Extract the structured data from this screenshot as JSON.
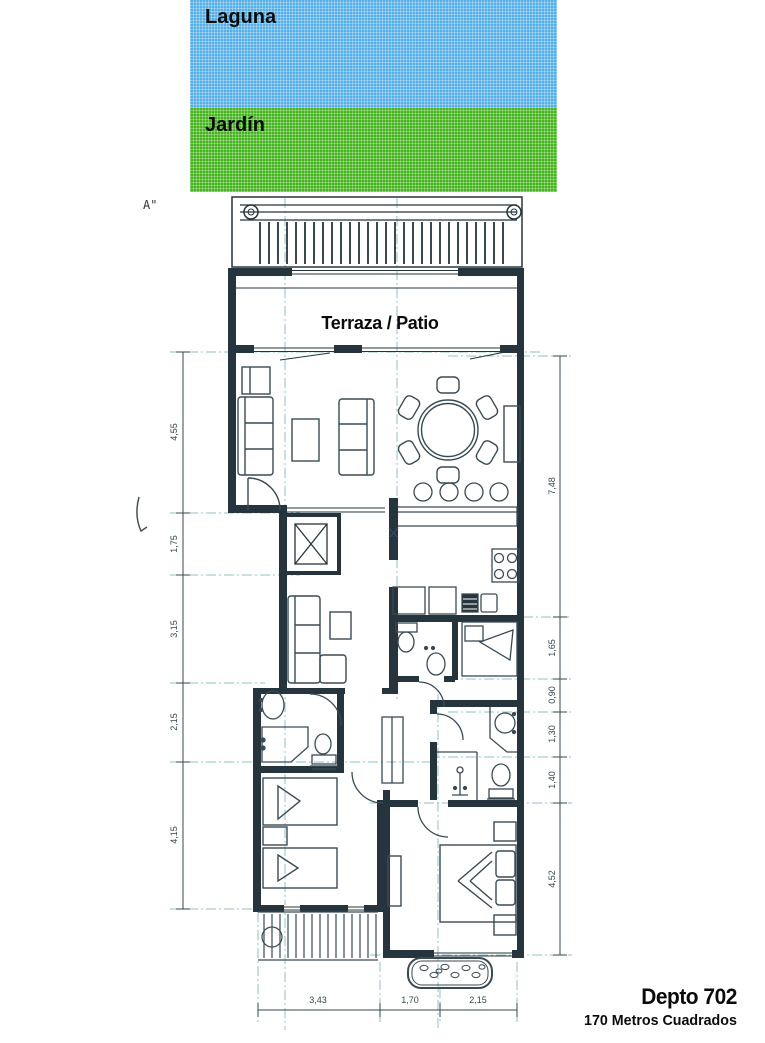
{
  "scene": {
    "laguna_label": "Laguna",
    "jardin_label": "Jardín",
    "section_marker": "A\"",
    "terraza_label": "Terraza / Patio",
    "title": "Depto 702",
    "subtitle": "170 Metros Cuadrados"
  },
  "colors": {
    "laguna_blue": "#53ade6",
    "jardin_green": "#45b41e",
    "ink": "#26343d",
    "axis_teal": "#8fc0c4",
    "dim": "#35474d"
  },
  "dimensions": {
    "left": [
      "4,55",
      "1,75",
      "3,15",
      "2,15",
      "4,15"
    ],
    "right": [
      "7,48",
      "1,65",
      "0,90",
      "1,30",
      "1,40",
      "4,52"
    ],
    "bottom": [
      "3,43",
      "1,70",
      "2,15"
    ]
  }
}
